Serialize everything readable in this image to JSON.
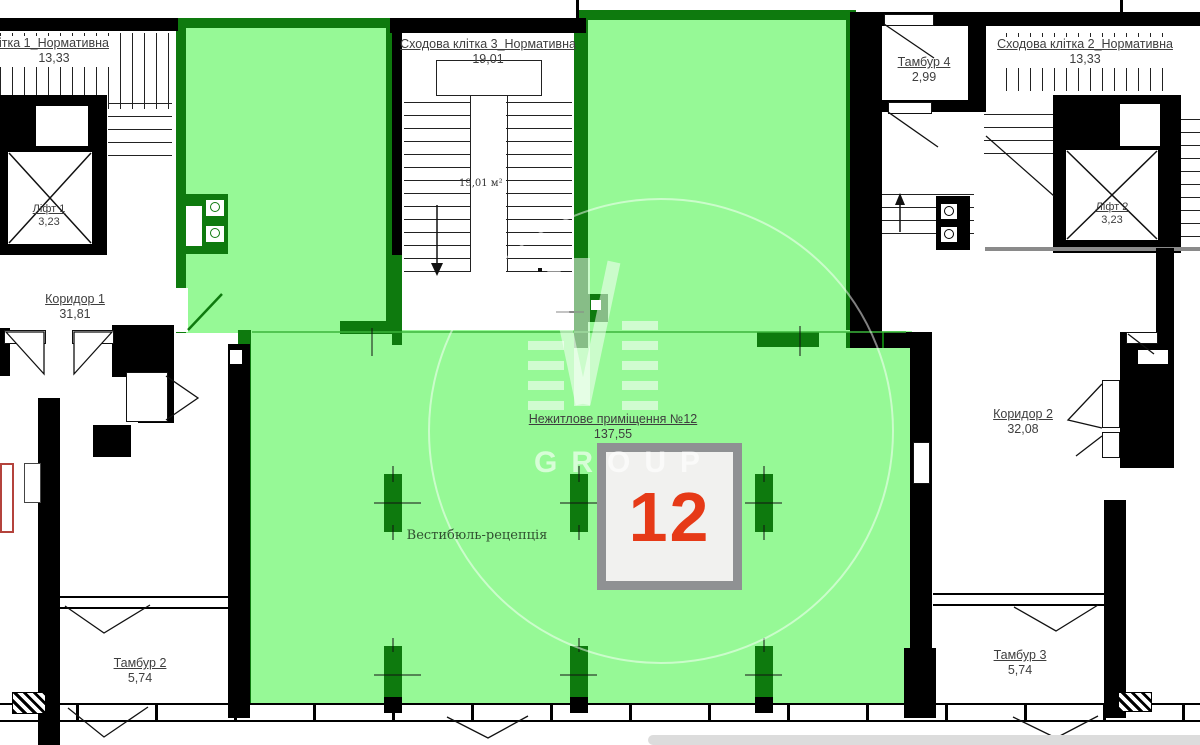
{
  "rooms": {
    "staircase1": {
      "name": "ітка 1_Нормативна",
      "area": "13,33"
    },
    "staircase3": {
      "name": "Сходова клітка 3_Нормативна",
      "area": "19,01",
      "inner_area": "19,01 м²"
    },
    "staircase2": {
      "name": "Сходова клітка 2_Нормативна",
      "area": "13,33"
    },
    "lift1": {
      "name": "Ліфт 1",
      "area": "3,23"
    },
    "lift2": {
      "name": "Ліфт 2",
      "area": "3,23"
    },
    "tambur4": {
      "name": "Тамбур 4",
      "area": "2,99"
    },
    "koridor1": {
      "name": "Коридор 1",
      "area": "31,81"
    },
    "koridor2": {
      "name": "Коридор 2",
      "area": "32,08"
    },
    "premise12": {
      "name": "Нежитлове приміщення №12",
      "area": "137,55"
    },
    "vestibule": {
      "name": "Вестибюль-рецепція"
    },
    "tambur2": {
      "name": "Тамбур 2",
      "area": "5,74"
    },
    "tambur3": {
      "name": "Тамбур 3",
      "area": "5,74"
    }
  },
  "unit_badge": {
    "number": "12"
  },
  "watermark": {
    "text": "GROUP"
  },
  "colors": {
    "highlight_fill": "#96f996",
    "highlight_border": "#0e7a0e",
    "unit_number_red": "#e63a17",
    "wall_black": "#000000",
    "box_border_gray": "#8f9193"
  }
}
